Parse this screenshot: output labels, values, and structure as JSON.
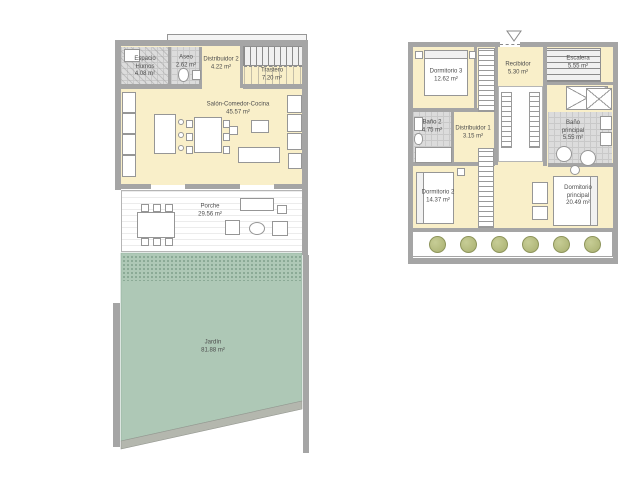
{
  "document": {
    "type": "floor-plan-sheet",
    "floors": 2
  },
  "colors": {
    "room_fill": "#f9efc9",
    "wall": "#a5a5a5",
    "tile_fill": "#dcdcdc",
    "garden_fill": "#aec8b6",
    "garden_wall": "#b9bcb4",
    "plant_fill": "#aeb478",
    "background": "#ffffff"
  },
  "ground_floor": {
    "rooms": {
      "espacio_humos": {
        "label": "Espacio Humos",
        "area": "4.08 m²"
      },
      "aseo": {
        "label": "Aseo",
        "area": "2.62 m²"
      },
      "distribuidor_2": {
        "label": "Distribuidor 2",
        "area": "4.22 m²"
      },
      "trastero": {
        "label": "Trastero",
        "area": "7.20 m²"
      },
      "salon_comedor_cocina": {
        "label": "Salón-Comedor-Cocina",
        "area": "45.57 m²"
      },
      "porche": {
        "label": "Porche",
        "area": "29.56 m²"
      },
      "jardin": {
        "label": "Jardín",
        "area": "81.88 m²"
      }
    }
  },
  "upper_floor": {
    "rooms": {
      "dormitorio_3": {
        "label": "Dormitorio 3",
        "area": "12.62 m²"
      },
      "recibidor": {
        "label": "Recibidor",
        "area": "5.30 m²"
      },
      "escalera": {
        "label": "Escalera",
        "area": "5.55 m²"
      },
      "bano_2": {
        "label": "Baño 2",
        "area": "4.75 m²"
      },
      "distribuidor_1": {
        "label": "Distribuidor 1",
        "area": "3.15 m²"
      },
      "bano_principal": {
        "label": "Baño principal",
        "area": "5.55 m²"
      },
      "dormitorio_2": {
        "label": "Dormitorio 2",
        "area": "14.37 m²"
      },
      "dormitorio_principal": {
        "label": "Dormitorio principal",
        "area": "20.49 m²"
      }
    }
  }
}
